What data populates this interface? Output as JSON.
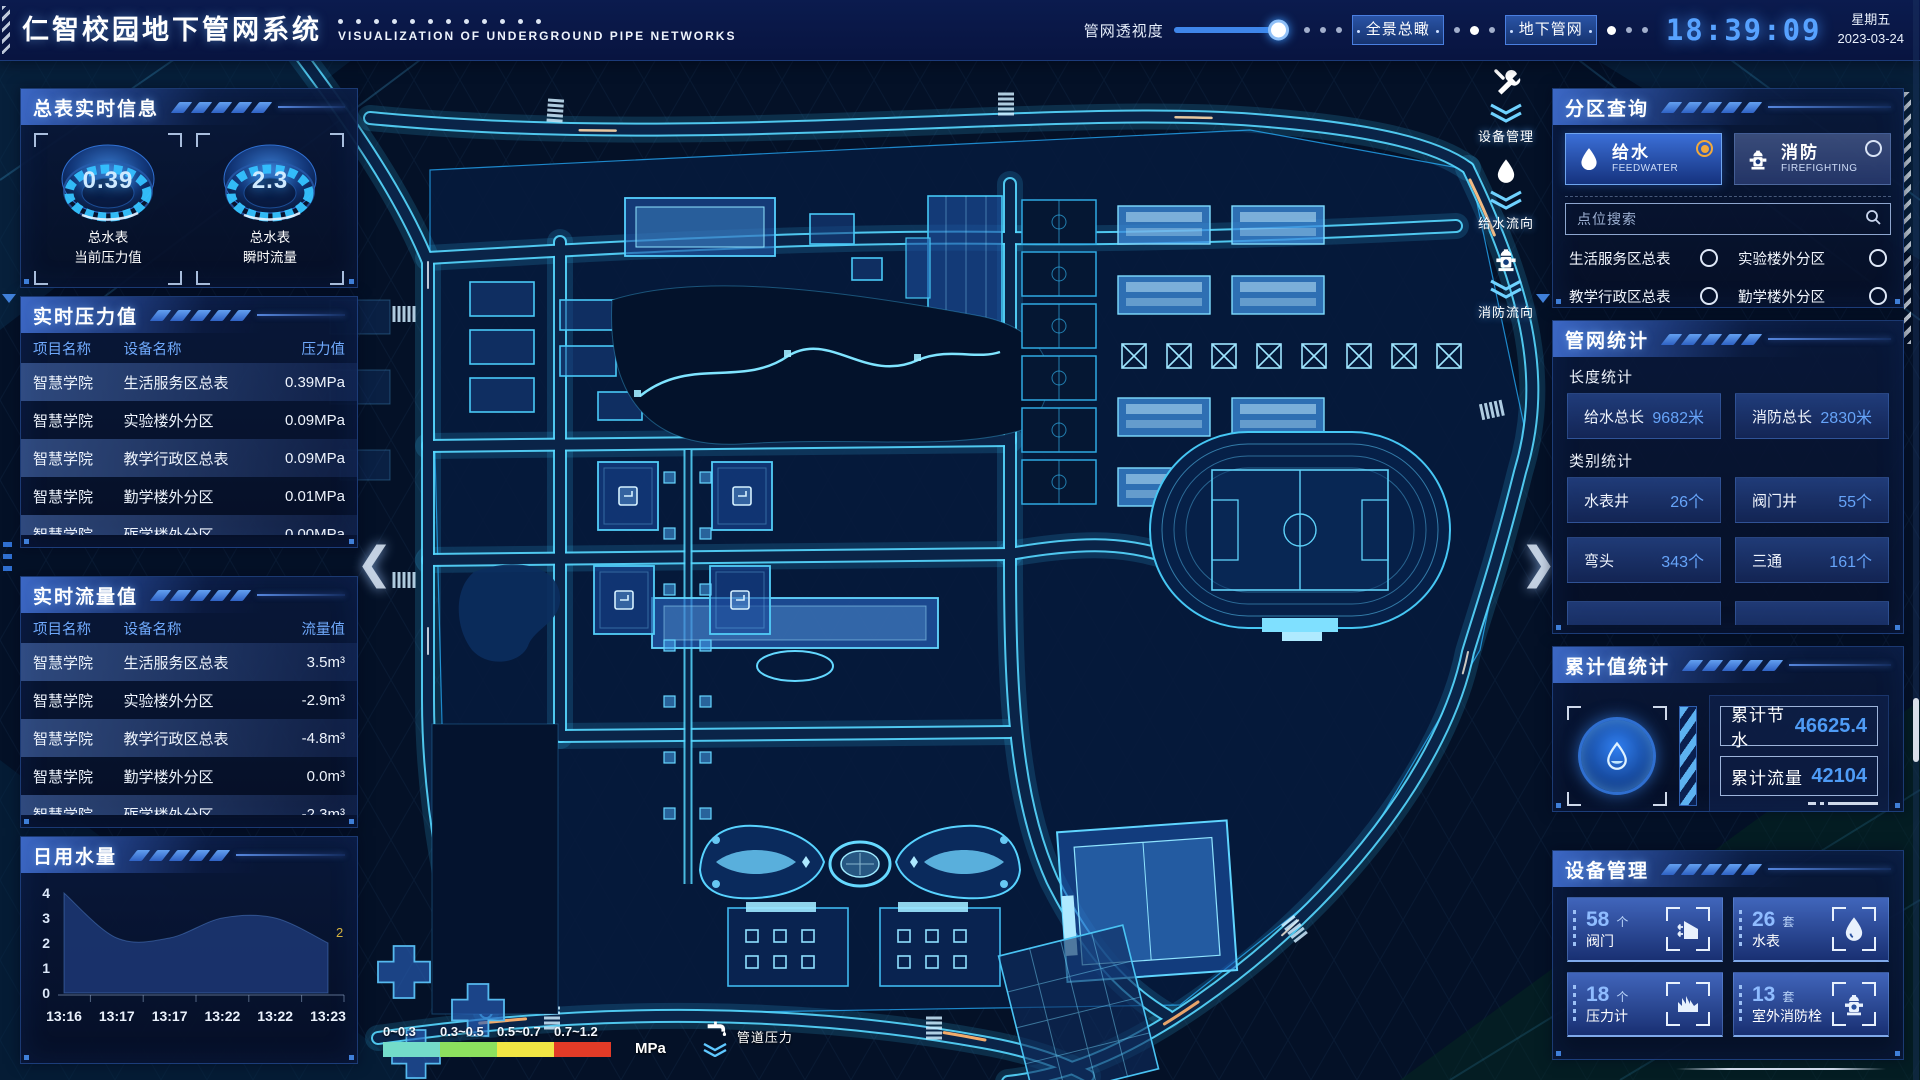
{
  "header": {
    "title": "仁智校园地下管网系统",
    "subtitle": "VISUALIZATION OF UNDERGROUND PIPE NETWORKS",
    "slider_label": "管网透视度",
    "slider_percent": 100,
    "view_buttons": [
      "全景总瞰",
      "地下管网"
    ],
    "time": "18:39:09",
    "weekday": "星期五",
    "date": "2023-03-24"
  },
  "left_panel": {
    "meter": {
      "title": "总表实时信息",
      "gauges": [
        {
          "value": "0.39",
          "label1": "总水表",
          "label2": "当前压力值"
        },
        {
          "value": "2.3",
          "label1": "总水表",
          "label2": "瞬时流量"
        }
      ]
    },
    "pressure": {
      "title": "实时压力值",
      "headers": [
        "项目名称",
        "设备名称",
        "压力值"
      ],
      "rows": [
        [
          "智慧学院",
          "生活服务区总表",
          "0.39MPa"
        ],
        [
          "智慧学院",
          "实验楼外分区",
          "0.09MPa"
        ],
        [
          "智慧学院",
          "教学行政区总表",
          "0.09MPa"
        ],
        [
          "智慧学院",
          "勤学楼外分区",
          "0.01MPa"
        ],
        [
          "智慧学院",
          "砺学楼外分区",
          "0.00MPa"
        ]
      ]
    },
    "flow": {
      "title": "实时流量值",
      "headers": [
        "项目名称",
        "设备名称",
        "流量值"
      ],
      "rows": [
        [
          "智慧学院",
          "生活服务区总表",
          "3.5m³"
        ],
        [
          "智慧学院",
          "实验楼外分区",
          "-2.9m³"
        ],
        [
          "智慧学院",
          "教学行政区总表",
          "-4.8m³"
        ],
        [
          "智慧学院",
          "勤学楼外分区",
          "0.0m³"
        ],
        [
          "智慧学院",
          "砺学楼外分区",
          "-2.3m³"
        ]
      ]
    },
    "daily": {
      "title": "日用水量"
    }
  },
  "chart_data": {
    "type": "area",
    "title": "日用水量",
    "x": [
      "13:16",
      "13:17",
      "13:17",
      "13:22",
      "13:22",
      "13:23"
    ],
    "values": [
      4,
      2.2,
      2.2,
      3,
      3,
      2
    ],
    "ylim": [
      0,
      4
    ],
    "yticks": [
      0,
      1,
      2,
      3,
      4
    ],
    "end_label": "2",
    "xlabel": "",
    "ylabel": "",
    "grid": false,
    "legend": false
  },
  "right_panel": {
    "zone_query": {
      "title": "分区查询",
      "tabs": [
        {
          "label": "给水",
          "sub": "FEEDWATER",
          "icon": "water-drop-icon",
          "selected": true
        },
        {
          "label": "消防",
          "sub": "FIREFIGHTING",
          "icon": "hydrant-icon",
          "selected": false
        }
      ],
      "search_placeholder": "点位搜索",
      "points": [
        "生活服务区总表",
        "实验楼外分区",
        "教学行政区总表",
        "勤学楼外分区",
        "砺学楼外分区",
        "宿舍区泵房"
      ]
    },
    "pipe_stats": {
      "title": "管网统计",
      "length_label": "长度统计",
      "length_items": [
        {
          "label": "给水总长",
          "value": "9682米"
        },
        {
          "label": "消防总长",
          "value": "2830米"
        }
      ],
      "category_label": "类别统计",
      "category_items": [
        {
          "label": "水表井",
          "value": "26个"
        },
        {
          "label": "阀门井",
          "value": "55个"
        },
        {
          "label": "弯头",
          "value": "343个"
        },
        {
          "label": "三通",
          "value": "161个"
        }
      ]
    },
    "cumulative": {
      "title": "累计值统计",
      "icon": "water-drop-icon",
      "items": [
        {
          "label": "累计节水",
          "value": "46625.4"
        },
        {
          "label": "累计流量",
          "value": "42104"
        }
      ]
    },
    "devices": {
      "title": "设备管理",
      "items": [
        {
          "count": "58",
          "unit": "个",
          "label": "阀门",
          "icon": "valve-icon"
        },
        {
          "count": "26",
          "unit": "套",
          "label": "水表",
          "icon": "water-meter-icon"
        },
        {
          "count": "18",
          "unit": "个",
          "label": "压力计",
          "icon": "pressure-gauge-icon"
        },
        {
          "count": "13",
          "unit": "套",
          "label": "室外消防栓",
          "icon": "hydrant-icon"
        }
      ]
    }
  },
  "map": {
    "side_buttons": [
      {
        "label": "设备管理",
        "icon": "tools-icon"
      },
      {
        "label": "给水流向",
        "icon": "water-drop-icon"
      },
      {
        "label": "消防流向",
        "icon": "hydrant-icon"
      }
    ],
    "legend": {
      "ranges": [
        "0~0.3",
        "0.3~0.5",
        "0.5~0.7",
        "0.7~1.2"
      ],
      "colors": [
        "#74dcc9",
        "#8ce05e",
        "#f1e644",
        "#e23b27"
      ],
      "unit": "MPa",
      "label": "管道压力",
      "icon": "faucet-icon"
    },
    "arrows": {
      "left": "❮",
      "right": "❯"
    }
  }
}
